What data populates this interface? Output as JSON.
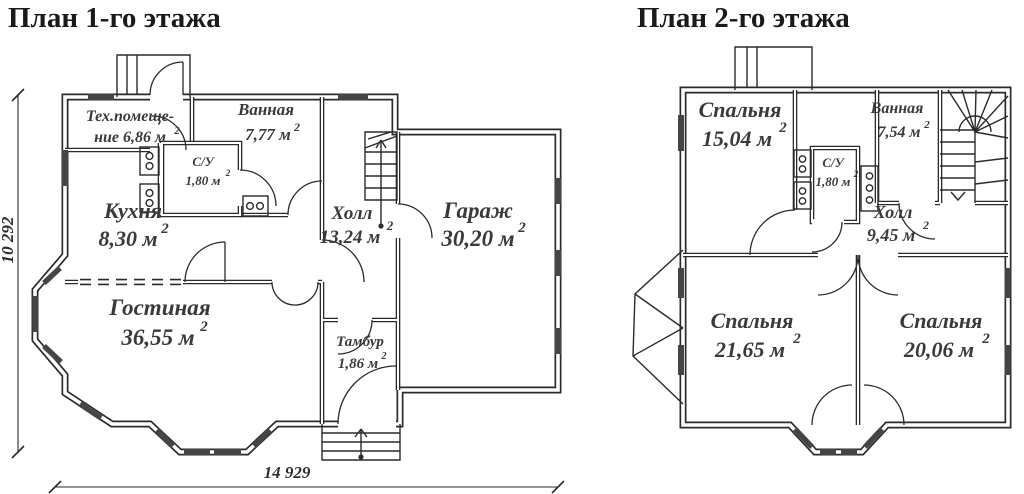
{
  "colors": {
    "ink": "#2b2b2b",
    "label_text": "#3a3a3a",
    "window_fill": "#454545",
    "background": "#ffffff"
  },
  "common": {
    "sup": "2"
  },
  "plan1": {
    "title": "План 1-го этажа",
    "rooms": {
      "tech": {
        "line1": "Тех.помеще-",
        "line2": "ние 6,86 м"
      },
      "bath": {
        "name": "Ванная",
        "area": "7,77 м"
      },
      "wc": {
        "name": "С/У",
        "area": "1,80 м"
      },
      "kitchen": {
        "name": "Кухня",
        "area": "8,30 м"
      },
      "hall": {
        "name": "Холл",
        "area": "13,24 м"
      },
      "garage": {
        "name": "Гараж",
        "area": "30,20 м"
      },
      "living": {
        "name": "Гостиная",
        "area": "36,55 м"
      },
      "tambour": {
        "name": "Тамбур",
        "area": "1,86 м"
      }
    },
    "dimensions": {
      "width": "14 929",
      "height": "10 292"
    }
  },
  "plan2": {
    "title": "План 2-го этажа",
    "rooms": {
      "bedroom1": {
        "name": "Спальня",
        "area": "15,04 м"
      },
      "bath": {
        "name": "Ванная",
        "area": "7,54 м"
      },
      "wc": {
        "name": "С/У",
        "area": "1,80 м"
      },
      "hall": {
        "name": "Холл",
        "area": "9,45 м"
      },
      "bedroom2": {
        "name": "Спальня",
        "area": "21,65 м"
      },
      "bedroom3": {
        "name": "Спальня",
        "area": "20,06 м"
      }
    }
  }
}
